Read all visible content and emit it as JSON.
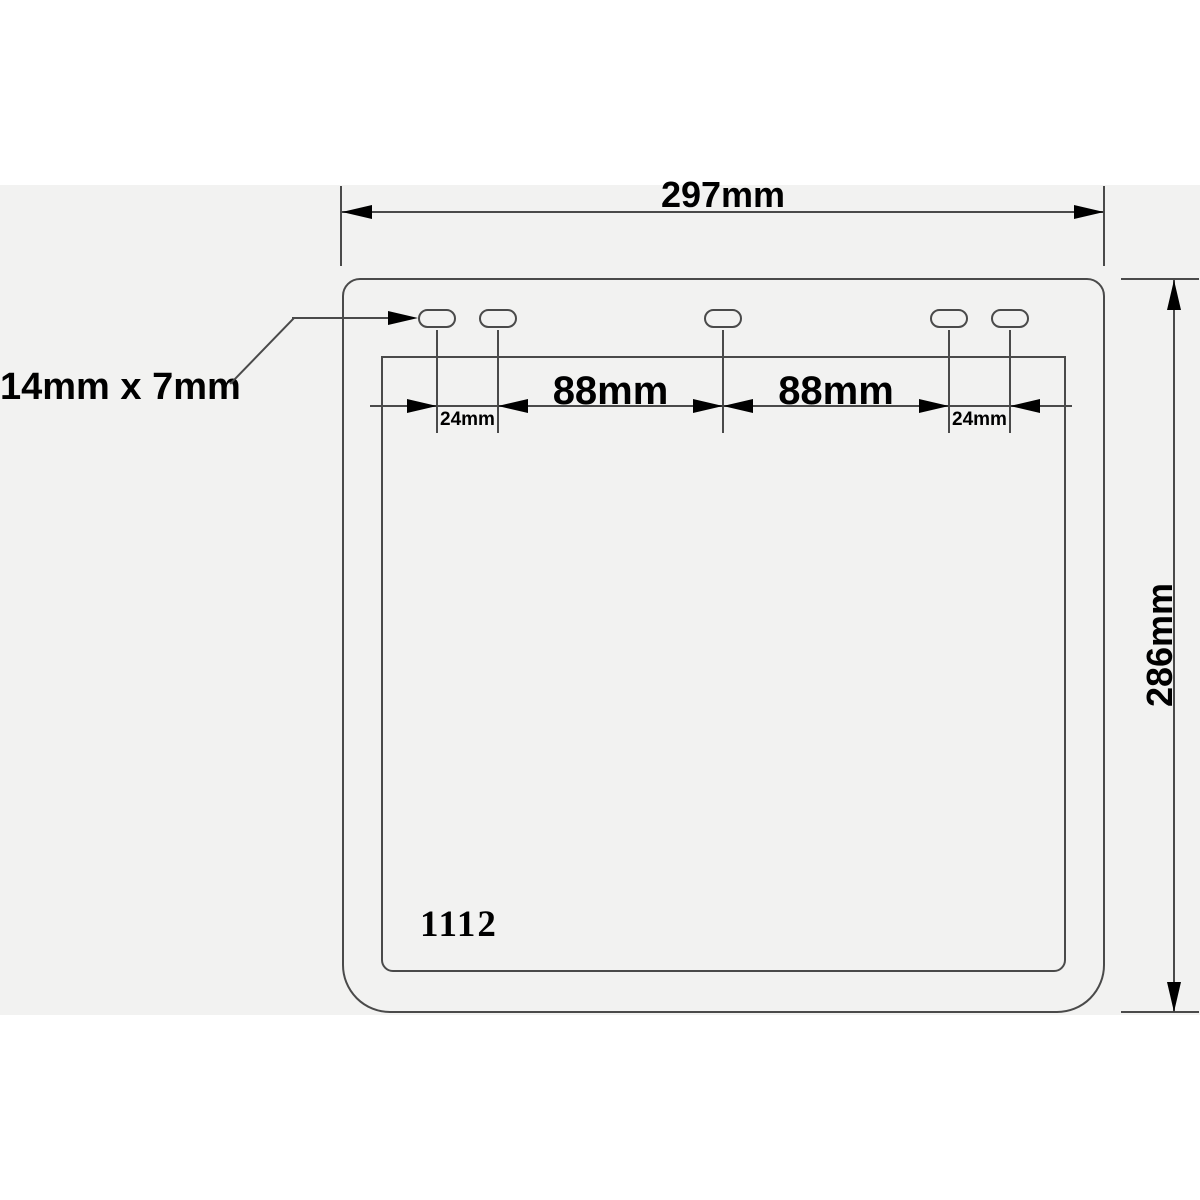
{
  "colors": {
    "canvas": "#ffffff",
    "panel": "#f2f2f1",
    "line": "#4a4a4a",
    "ink": "#000000"
  },
  "diagram": {
    "kind": "mudflap-dimension-drawing",
    "labels": {
      "overall_width": "297mm",
      "overall_height": "286mm",
      "slot_size": "14mm x 7mm",
      "offset_left": "24mm",
      "pitch_left": "88mm",
      "pitch_right": "88mm",
      "offset_right": "24mm",
      "part_number": "1112"
    },
    "slot_count": 5
  }
}
